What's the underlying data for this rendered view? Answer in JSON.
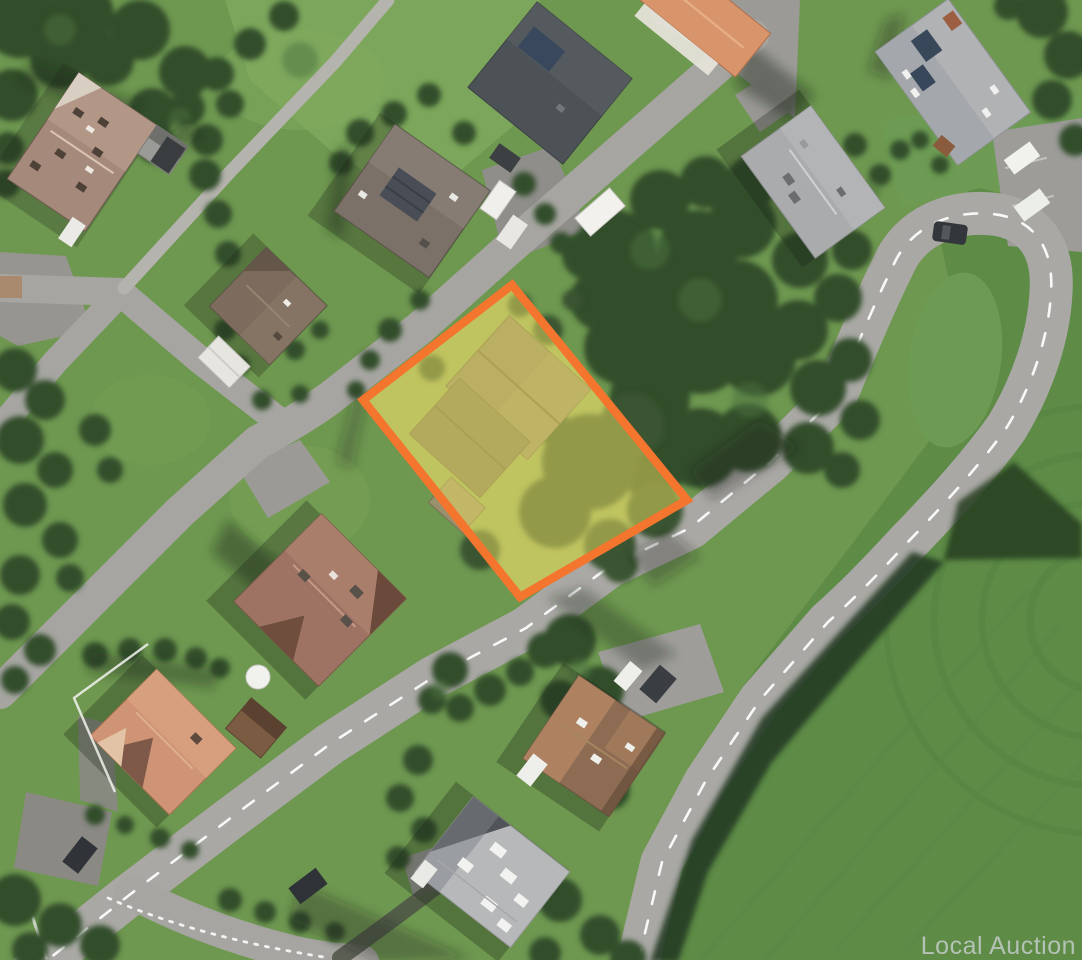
{
  "image_type": "satellite aerial photograph of a residential neighborhood with a highlighted land parcel",
  "watermark": {
    "text": "Local Auction",
    "color": "#ccd1d5"
  },
  "parcel": {
    "polygon_points": "512,285 687,500 520,597 363,400",
    "border_color": "#f4752e",
    "fill_color": "#eadd5f",
    "fill_opacity": "0.5"
  },
  "palette": {
    "grass": "#6e9750",
    "field": "#5e8c47",
    "field_inner": "#6d9b53",
    "road": "#a6a5a1",
    "main_road": "#a9a8a4",
    "path": "#b5b3ad",
    "tree": "#314e2c",
    "tree_dark": "#243c22",
    "road_marking": "#ffffff"
  }
}
